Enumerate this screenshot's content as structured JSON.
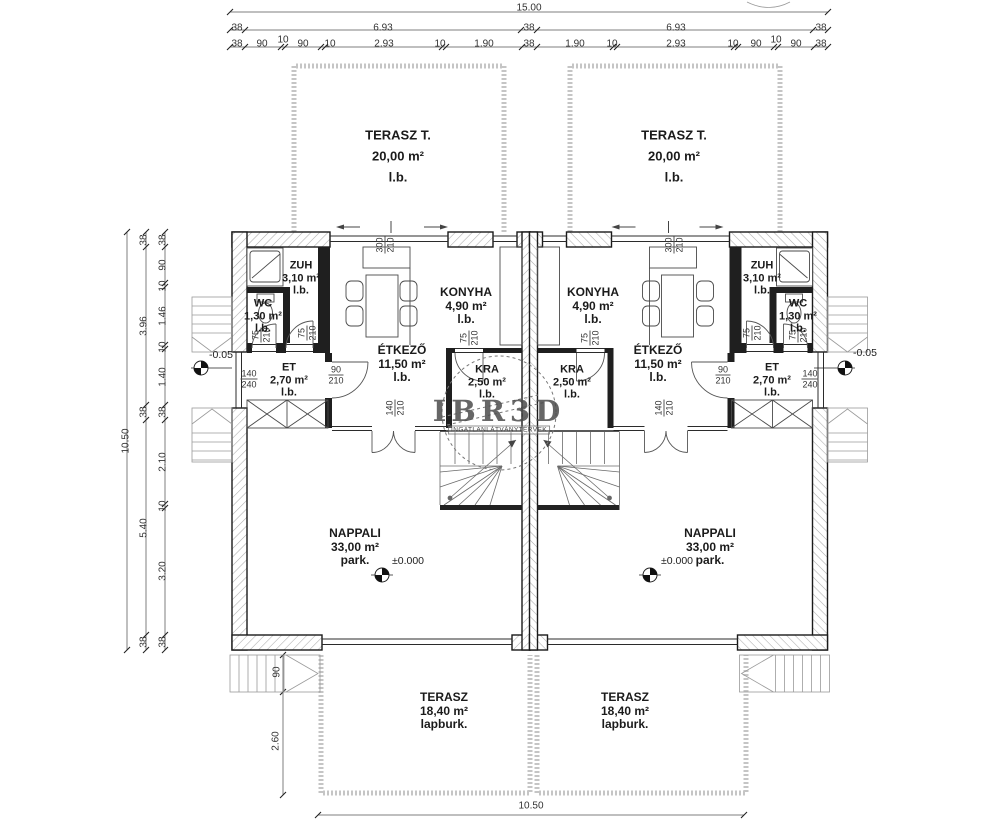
{
  "watermark": {
    "big": "IBR3D",
    "sub": "INGATLANLÁTVÁNYTERVEK"
  },
  "labels": [
    {
      "name": "dim-overall-top",
      "cls": "dim",
      "x": 529,
      "y": 8,
      "text": "15.00"
    },
    {
      "name": "dim-label",
      "cls": "dim",
      "x": 237,
      "y": 28,
      "text": "38"
    },
    {
      "name": "dim-label",
      "cls": "dim",
      "x": 383,
      "y": 28,
      "text": "6.93"
    },
    {
      "name": "dim-label",
      "cls": "dim",
      "x": 529,
      "y": 28,
      "text": "38"
    },
    {
      "name": "dim-label",
      "cls": "dim",
      "x": 676,
      "y": 28,
      "text": "6.93"
    },
    {
      "name": "dim-label",
      "cls": "dim",
      "x": 821,
      "y": 28,
      "text": "38"
    },
    {
      "name": "dim-label",
      "cls": "dim",
      "x": 237,
      "y": 44,
      "text": "38"
    },
    {
      "name": "dim-label",
      "cls": "dim",
      "x": 262,
      "y": 44,
      "text": "90"
    },
    {
      "name": "dim-label",
      "cls": "dim",
      "x": 283,
      "y": 40,
      "text": "10"
    },
    {
      "name": "dim-label",
      "cls": "dim",
      "x": 303,
      "y": 44,
      "text": "90"
    },
    {
      "name": "dim-label",
      "cls": "dim",
      "x": 330,
      "y": 44,
      "text": "10"
    },
    {
      "name": "dim-label",
      "cls": "dim",
      "x": 384,
      "y": 44,
      "text": "2.93"
    },
    {
      "name": "dim-label",
      "cls": "dim",
      "x": 440,
      "y": 44,
      "text": "10"
    },
    {
      "name": "dim-label",
      "cls": "dim",
      "x": 484,
      "y": 44,
      "text": "1.90"
    },
    {
      "name": "dim-label",
      "cls": "dim",
      "x": 529,
      "y": 44,
      "text": "38"
    },
    {
      "name": "dim-label",
      "cls": "dim",
      "x": 575,
      "y": 44,
      "text": "1.90"
    },
    {
      "name": "dim-label",
      "cls": "dim",
      "x": 612,
      "y": 44,
      "text": "10"
    },
    {
      "name": "dim-label",
      "cls": "dim",
      "x": 676,
      "y": 44,
      "text": "2.93"
    },
    {
      "name": "dim-label",
      "cls": "dim",
      "x": 733,
      "y": 44,
      "text": "10"
    },
    {
      "name": "dim-label",
      "cls": "dim",
      "x": 756,
      "y": 44,
      "text": "90"
    },
    {
      "name": "dim-label",
      "cls": "dim",
      "x": 776,
      "y": 40,
      "text": "10"
    },
    {
      "name": "dim-label",
      "cls": "dim",
      "x": 796,
      "y": 44,
      "text": "90"
    },
    {
      "name": "dim-label",
      "cls": "dim",
      "x": 821,
      "y": 44,
      "text": "38"
    },
    {
      "name": "dim-overall-left",
      "cls": "dim rot",
      "x": 126,
      "y": 441,
      "text": "10.50"
    },
    {
      "name": "dim-label",
      "cls": "dim rot",
      "x": 144,
      "y": 240,
      "text": "38"
    },
    {
      "name": "dim-label",
      "cls": "dim rot",
      "x": 144,
      "y": 326,
      "text": "3.96"
    },
    {
      "name": "dim-label",
      "cls": "dim rot",
      "x": 144,
      "y": 412,
      "text": "38"
    },
    {
      "name": "dim-label",
      "cls": "dim rot",
      "x": 144,
      "y": 528,
      "text": "5.40"
    },
    {
      "name": "dim-label",
      "cls": "dim rot",
      "x": 144,
      "y": 642,
      "text": "38"
    },
    {
      "name": "dim-label",
      "cls": "dim rot",
      "x": 163,
      "y": 240,
      "text": "38"
    },
    {
      "name": "dim-label",
      "cls": "dim rot",
      "x": 163,
      "y": 265,
      "text": "90"
    },
    {
      "name": "dim-label",
      "cls": "dim rot",
      "x": 163,
      "y": 286,
      "text": "10"
    },
    {
      "name": "dim-label",
      "cls": "dim rot",
      "x": 163,
      "y": 316,
      "text": "1.46"
    },
    {
      "name": "dim-label",
      "cls": "dim rot",
      "x": 163,
      "y": 347,
      "text": "10"
    },
    {
      "name": "dim-label",
      "cls": "dim rot",
      "x": 163,
      "y": 377,
      "text": "1.40"
    },
    {
      "name": "dim-label",
      "cls": "dim rot",
      "x": 163,
      "y": 412,
      "text": "38"
    },
    {
      "name": "dim-label",
      "cls": "dim rot",
      "x": 163,
      "y": 462,
      "text": "2.10"
    },
    {
      "name": "dim-label",
      "cls": "dim rot",
      "x": 163,
      "y": 506,
      "text": "10"
    },
    {
      "name": "dim-label",
      "cls": "dim rot",
      "x": 163,
      "y": 571,
      "text": "3.20"
    },
    {
      "name": "dim-label",
      "cls": "dim rot",
      "x": 163,
      "y": 642,
      "text": "38"
    },
    {
      "name": "dim-label",
      "cls": "dim rot",
      "x": 277,
      "y": 672,
      "text": "90"
    },
    {
      "name": "dim-label",
      "cls": "dim rot",
      "x": 276,
      "y": 741,
      "text": "2.60"
    },
    {
      "name": "dim-overall-bottom",
      "cls": "dim",
      "x": 531,
      "y": 806,
      "text": "10.50"
    },
    {
      "name": "level-label",
      "cls": "lvl",
      "x": 221,
      "y": 355,
      "text": "-0.05"
    },
    {
      "name": "level-label",
      "cls": "lvl",
      "x": 865,
      "y": 353,
      "text": "-0.05"
    },
    {
      "name": "level-label",
      "cls": "lvl",
      "x": 408,
      "y": 561,
      "text": "±0.000"
    },
    {
      "name": "level-label",
      "cls": "lvl",
      "x": 677,
      "y": 561,
      "text": "±0.000"
    },
    {
      "name": "door-size-label",
      "cls": "frac rot",
      "x": 261,
      "y": 335,
      "lines": [
        "75",
        "210"
      ]
    },
    {
      "name": "door-size-label",
      "cls": "frac rot",
      "x": 307,
      "y": 333,
      "lines": [
        "75",
        "210"
      ]
    },
    {
      "name": "door-size-label",
      "cls": "frac rot",
      "x": 469,
      "y": 338,
      "lines": [
        "75",
        "210"
      ]
    },
    {
      "name": "door-size-label",
      "cls": "frac rot",
      "x": 385,
      "y": 245,
      "lines": [
        "300",
        "210"
      ]
    },
    {
      "name": "door-size-label",
      "cls": "frac rot",
      "x": 395,
      "y": 408,
      "lines": [
        "140",
        "210"
      ]
    },
    {
      "name": "door-size-label",
      "cls": "frac rot",
      "x": 798,
      "y": 335,
      "lines": [
        "75",
        "210"
      ]
    },
    {
      "name": "door-size-label",
      "cls": "frac rot",
      "x": 752,
      "y": 333,
      "lines": [
        "75",
        "210"
      ]
    },
    {
      "name": "door-size-label",
      "cls": "frac rot",
      "x": 590,
      "y": 338,
      "lines": [
        "75",
        "210"
      ]
    },
    {
      "name": "door-size-label",
      "cls": "frac rot",
      "x": 674,
      "y": 245,
      "lines": [
        "300",
        "210"
      ]
    },
    {
      "name": "door-size-label",
      "cls": "frac rot",
      "x": 664,
      "y": 408,
      "lines": [
        "140",
        "210"
      ]
    },
    {
      "name": "door-size-label",
      "cls": "frac",
      "x": 249,
      "y": 379,
      "lines": [
        "140",
        "240"
      ]
    },
    {
      "name": "door-size-label",
      "cls": "frac",
      "x": 336,
      "y": 375,
      "lines": [
        "90",
        "210"
      ]
    },
    {
      "name": "door-size-label",
      "cls": "frac",
      "x": 810,
      "y": 379,
      "lines": [
        "140",
        "240"
      ]
    },
    {
      "name": "door-size-label",
      "cls": "frac",
      "x": 723,
      "y": 375,
      "lines": [
        "90",
        "210"
      ]
    },
    {
      "name": "room-label-terasz-t-left",
      "cls": "roomlg",
      "x": 398,
      "y": 156,
      "lines": [
        "TERASZ T.",
        "20,00 m²",
        "l.b."
      ]
    },
    {
      "name": "room-label-terasz-t-right",
      "cls": "roomlg",
      "x": 674,
      "y": 156,
      "lines": [
        "TERASZ T.",
        "20,00 m²",
        "l.b."
      ]
    },
    {
      "name": "room-label-zuh-left",
      "cls": "roomsm",
      "x": 301,
      "y": 278,
      "lines": [
        "ZUH",
        "3,10 m²",
        "l.b."
      ]
    },
    {
      "name": "room-label-zuh-right",
      "cls": "roomsm",
      "x": 762,
      "y": 278,
      "lines": [
        "ZUH",
        "3,10 m²",
        "l.b."
      ]
    },
    {
      "name": "room-label-wc-left",
      "cls": "roomsm",
      "x": 263,
      "y": 316,
      "lines": [
        "WC",
        "1,30 m²",
        "l.b."
      ]
    },
    {
      "name": "room-label-wc-right",
      "cls": "roomsm",
      "x": 798,
      "y": 316,
      "lines": [
        "WC",
        "1,30 m²",
        "l.b."
      ]
    },
    {
      "name": "room-label-et-left",
      "cls": "roomsm",
      "x": 289,
      "y": 380,
      "lines": [
        "ET",
        "2,70 m²",
        "l.b."
      ]
    },
    {
      "name": "room-label-et-right",
      "cls": "roomsm",
      "x": 772,
      "y": 380,
      "lines": [
        "ET",
        "2,70 m²",
        "l.b."
      ]
    },
    {
      "name": "room-label-etkezo-left",
      "cls": "room",
      "x": 402,
      "y": 364,
      "lines": [
        "ÉTKEZŐ",
        "11,50 m²",
        "l.b."
      ]
    },
    {
      "name": "room-label-etkezo-right",
      "cls": "room",
      "x": 658,
      "y": 364,
      "lines": [
        "ÉTKEZŐ",
        "11,50 m²",
        "l.b."
      ]
    },
    {
      "name": "room-label-konyha-left",
      "cls": "room",
      "x": 466,
      "y": 306,
      "lines": [
        "KONYHA",
        "4,90 m²",
        "l.b."
      ]
    },
    {
      "name": "room-label-konyha-right",
      "cls": "room",
      "x": 593,
      "y": 306,
      "lines": [
        "KONYHA",
        "4,90 m²",
        "l.b."
      ]
    },
    {
      "name": "room-label-kra-left",
      "cls": "roomsm",
      "x": 487,
      "y": 382,
      "lines": [
        "KRA",
        "2,50 m²",
        "l.b."
      ]
    },
    {
      "name": "room-label-kra-right",
      "cls": "roomsm",
      "x": 572,
      "y": 382,
      "lines": [
        "KRA",
        "2,50 m²",
        "l.b."
      ]
    },
    {
      "name": "room-label-nappali-left",
      "cls": "room",
      "x": 355,
      "y": 547,
      "lines": [
        "NAPPALI",
        "33,00 m²",
        "park."
      ]
    },
    {
      "name": "room-label-nappali-right",
      "cls": "room",
      "x": 710,
      "y": 547,
      "lines": [
        "NAPPALI",
        "33,00 m²",
        "park."
      ]
    },
    {
      "name": "room-label-terasz-left",
      "cls": "room",
      "x": 444,
      "y": 711,
      "lines": [
        "TERASZ",
        "18,40 m²",
        "lapburk."
      ]
    },
    {
      "name": "room-label-terasz-right",
      "cls": "room",
      "x": 625,
      "y": 711,
      "lines": [
        "TERASZ",
        "18,40 m²",
        "lapburk."
      ]
    }
  ]
}
